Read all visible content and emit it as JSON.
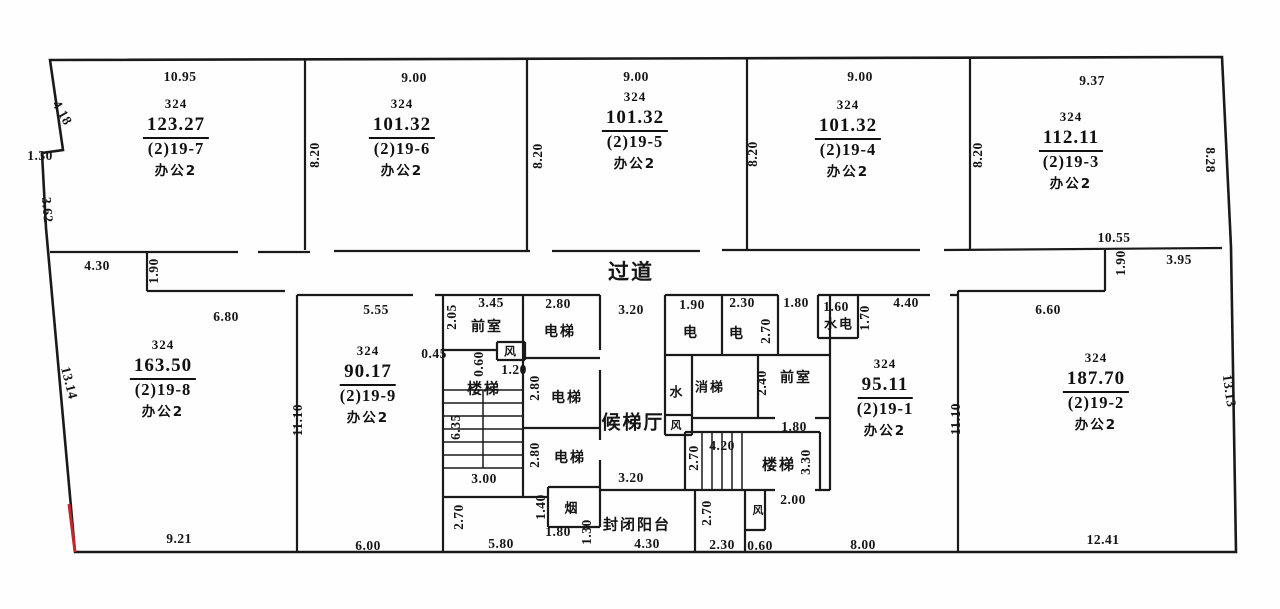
{
  "drawing": {
    "type": "floor-plan-survey",
    "corridor": "过道"
  },
  "colors": {
    "ink": "#151515",
    "wall": "#1a1a1a",
    "accent_red": "#c1272d",
    "paper": "#fefefe"
  },
  "units": [
    {
      "parcel": "324",
      "area": "123.27",
      "no": "(2)19-7",
      "use": "办公2",
      "cx": 176,
      "top": 95
    },
    {
      "parcel": "324",
      "area": "101.32",
      "no": "(2)19-6",
      "use": "办公2",
      "cx": 402,
      "top": 95
    },
    {
      "parcel": "324",
      "area": "101.32",
      "no": "(2)19-5",
      "use": "办公2",
      "cx": 635,
      "top": 88
    },
    {
      "parcel": "324",
      "area": "101.32",
      "no": "(2)19-4",
      "use": "办公2",
      "cx": 848,
      "top": 96
    },
    {
      "parcel": "324",
      "area": "112.11",
      "no": "(2)19-3",
      "use": "办公2",
      "cx": 1071,
      "top": 108
    },
    {
      "parcel": "324",
      "area": "163.50",
      "no": "(2)19-8",
      "use": "办公2",
      "cx": 163,
      "top": 336
    },
    {
      "parcel": "324",
      "area": "90.17",
      "no": "(2)19-9",
      "use": "办公2",
      "cx": 368,
      "top": 342
    },
    {
      "parcel": "324",
      "area": "95.11",
      "no": "(2)19-1",
      "use": "办公2",
      "cx": 885,
      "top": 355
    },
    {
      "parcel": "324",
      "area": "187.70",
      "no": "(2)19-2",
      "use": "办公2",
      "cx": 1096,
      "top": 349
    }
  ],
  "labels": [
    {
      "t": "10.95",
      "x": 180,
      "y": 77
    },
    {
      "t": "9.00",
      "x": 414,
      "y": 78
    },
    {
      "t": "9.00",
      "x": 636,
      "y": 77
    },
    {
      "t": "9.00",
      "x": 860,
      "y": 77
    },
    {
      "t": "9.37",
      "x": 1092,
      "y": 81
    },
    {
      "t": "4.18",
      "x": 62,
      "y": 113,
      "r": 60
    },
    {
      "t": "1.30",
      "x": 40,
      "y": 156
    },
    {
      "t": "3.62",
      "x": 47,
      "y": 210,
      "r": 85
    },
    {
      "t": "13.14",
      "x": 69,
      "y": 383,
      "r": 76
    },
    {
      "t": "8.28",
      "x": 1210,
      "y": 160,
      "r": 90
    },
    {
      "t": "13.13",
      "x": 1229,
      "y": 391,
      "r": 82
    },
    {
      "t": "8.20",
      "x": 315,
      "y": 155,
      "r": -90
    },
    {
      "t": "8.20",
      "x": 538,
      "y": 156,
      "r": -90
    },
    {
      "t": "8.20",
      "x": 753,
      "y": 154,
      "r": -90
    },
    {
      "t": "8.20",
      "x": 978,
      "y": 155,
      "r": -90
    },
    {
      "t": "4.30",
      "x": 97,
      "y": 266
    },
    {
      "t": "1.90",
      "x": 154,
      "y": 271,
      "r": -90
    },
    {
      "t": "6.80",
      "x": 226,
      "y": 317
    },
    {
      "t": "过道",
      "x": 631,
      "y": 271,
      "s": 21,
      "c": 1,
      "n": "corridor-label"
    },
    {
      "t": "10.55",
      "x": 1114,
      "y": 238
    },
    {
      "t": "1.90",
      "x": 1121,
      "y": 263,
      "r": -90
    },
    {
      "t": "3.95",
      "x": 1179,
      "y": 260
    },
    {
      "t": "6.60",
      "x": 1048,
      "y": 310
    },
    {
      "t": "5.55",
      "x": 376,
      "y": 310
    },
    {
      "t": "2.05",
      "x": 452,
      "y": 317,
      "r": -90
    },
    {
      "t": "3.45",
      "x": 491,
      "y": 303
    },
    {
      "t": "前室",
      "x": 487,
      "y": 326,
      "s": 14,
      "c": 1,
      "n": "anteroom-label"
    },
    {
      "t": "2.80",
      "x": 558,
      "y": 304
    },
    {
      "t": "电梯",
      "x": 560,
      "y": 331,
      "s": 14,
      "c": 1,
      "n": "elevator-label"
    },
    {
      "t": "3.20",
      "x": 631,
      "y": 310
    },
    {
      "t": "1.90",
      "x": 692,
      "y": 305
    },
    {
      "t": "电",
      "x": 691,
      "y": 332,
      "s": 14,
      "c": 1,
      "n": "electric-shaft-label"
    },
    {
      "t": "2.30",
      "x": 742,
      "y": 303
    },
    {
      "t": "电",
      "x": 737,
      "y": 333,
      "s": 14,
      "c": 1,
      "n": "electric-shaft-label"
    },
    {
      "t": "2.70",
      "x": 766,
      "y": 331,
      "r": -90
    },
    {
      "t": "1.80",
      "x": 796,
      "y": 303
    },
    {
      "t": "1.60",
      "x": 836,
      "y": 307
    },
    {
      "t": "水电",
      "x": 839,
      "y": 323,
      "s": 13,
      "c": 1,
      "n": "water-electric-label"
    },
    {
      "t": "1.70",
      "x": 865,
      "y": 318,
      "r": -90
    },
    {
      "t": "4.40",
      "x": 906,
      "y": 303
    },
    {
      "t": "0.45",
      "x": 434,
      "y": 354
    },
    {
      "t": "0.60",
      "x": 479,
      "y": 364,
      "r": -90
    },
    {
      "t": "风",
      "x": 511,
      "y": 351,
      "s": 12,
      "c": 1,
      "n": "air-shaft-label"
    },
    {
      "t": "1.20",
      "x": 514,
      "y": 370
    },
    {
      "t": "楼梯",
      "x": 484,
      "y": 388,
      "s": 15,
      "c": 1,
      "n": "stairs-label"
    },
    {
      "t": "6.35",
      "x": 456,
      "y": 427,
      "r": -90
    },
    {
      "t": "2.80",
      "x": 535,
      "y": 388,
      "r": -90
    },
    {
      "t": "电梯",
      "x": 567,
      "y": 397,
      "s": 14,
      "c": 1,
      "n": "elevator-label"
    },
    {
      "t": "候梯厅",
      "x": 633,
      "y": 421,
      "s": 19,
      "c": 1,
      "n": "elevator-lobby-label"
    },
    {
      "t": "水",
      "x": 677,
      "y": 391,
      "s": 13,
      "c": 1,
      "n": "water-shaft-label"
    },
    {
      "t": "消梯",
      "x": 710,
      "y": 386,
      "s": 13,
      "c": 1,
      "n": "fire-elevator-label"
    },
    {
      "t": "2.40",
      "x": 762,
      "y": 383,
      "r": -90
    },
    {
      "t": "前室",
      "x": 796,
      "y": 377,
      "s": 14,
      "c": 1,
      "n": "anteroom-label"
    },
    {
      "t": "1.80",
      "x": 794,
      "y": 427
    },
    {
      "t": "风",
      "x": 677,
      "y": 425,
      "s": 11,
      "c": 1,
      "n": "air-shaft-label"
    },
    {
      "t": "2.80",
      "x": 535,
      "y": 455,
      "r": -90
    },
    {
      "t": "电梯",
      "x": 570,
      "y": 457,
      "s": 14,
      "c": 1,
      "n": "elevator-label"
    },
    {
      "t": "3.00",
      "x": 484,
      "y": 479
    },
    {
      "t": "3.20",
      "x": 631,
      "y": 478
    },
    {
      "t": "4.20",
      "x": 722,
      "y": 446
    },
    {
      "t": "2.70",
      "x": 694,
      "y": 458,
      "r": -90
    },
    {
      "t": "楼梯",
      "x": 779,
      "y": 464,
      "s": 15,
      "c": 1,
      "n": "stairs-label"
    },
    {
      "t": "3.30",
      "x": 806,
      "y": 462,
      "r": -90
    },
    {
      "t": "11.10",
      "x": 298,
      "y": 420,
      "r": -90
    },
    {
      "t": "11.10",
      "x": 956,
      "y": 419,
      "r": -90
    },
    {
      "t": "2.70",
      "x": 459,
      "y": 517,
      "r": -90
    },
    {
      "t": "1.40",
      "x": 541,
      "y": 507,
      "r": -90
    },
    {
      "t": "烟",
      "x": 572,
      "y": 507,
      "s": 13,
      "c": 1,
      "n": "smoke-shaft-label"
    },
    {
      "t": "1.80",
      "x": 558,
      "y": 532
    },
    {
      "t": "1.30",
      "x": 587,
      "y": 532,
      "r": -90
    },
    {
      "t": "封闭阳台",
      "x": 637,
      "y": 524,
      "s": 15,
      "c": 1,
      "n": "enclosed-balcony-label"
    },
    {
      "t": "2.70",
      "x": 707,
      "y": 513,
      "r": -90
    },
    {
      "t": "风",
      "x": 759,
      "y": 510,
      "s": 11,
      "c": 1,
      "n": "air-shaft-label"
    },
    {
      "t": "2.00",
      "x": 793,
      "y": 500
    },
    {
      "t": "5.80",
      "x": 501,
      "y": 544
    },
    {
      "t": "9.21",
      "x": 179,
      "y": 539
    },
    {
      "t": "6.00",
      "x": 368,
      "y": 546
    },
    {
      "t": "4.30",
      "x": 647,
      "y": 544
    },
    {
      "t": "2.30",
      "x": 722,
      "y": 545
    },
    {
      "t": "0.60",
      "x": 760,
      "y": 546
    },
    {
      "t": "8.00",
      "x": 863,
      "y": 545
    },
    {
      "t": "12.41",
      "x": 1103,
      "y": 540
    }
  ]
}
